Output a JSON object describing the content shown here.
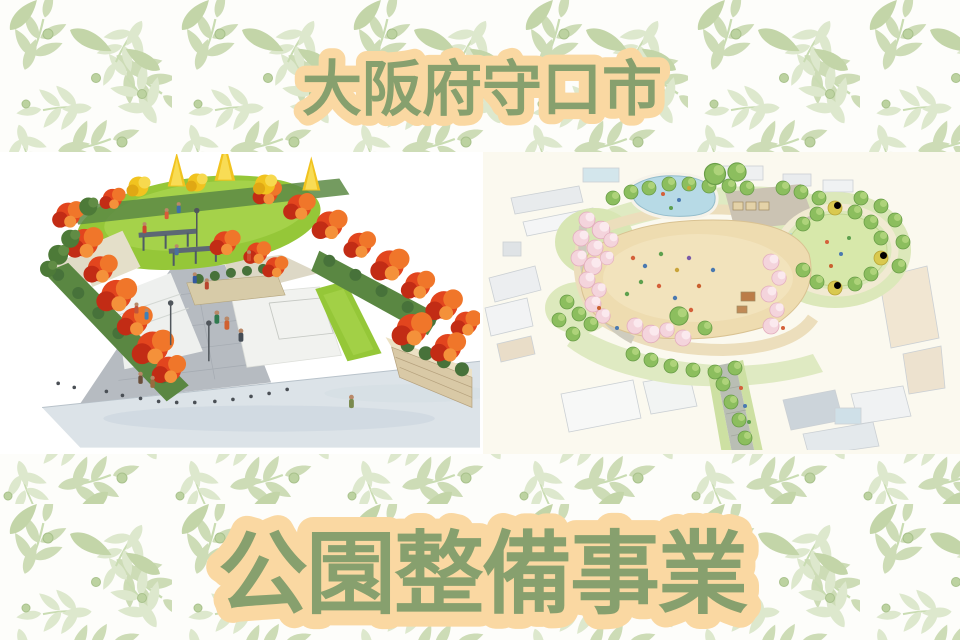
{
  "banner": {
    "top_title": "大阪府守口市",
    "bottom_title": "公園整備事業"
  },
  "illustrations": {
    "left_name": "autumn-park-perspective-illustration",
    "right_name": "park-aerial-plan-illustration"
  },
  "colors": {
    "title_green": "#87a06e",
    "title_outline_peach": "#fad8a2",
    "leaf_pattern_green": "#cddcb6",
    "leaf_pattern_green_light": "#dde8cd",
    "band_white": "#ffffff",
    "right_panel_cream": "#fbf9ef",
    "lawn_green": "#95c738",
    "autumn_red": "#e2451e",
    "autumn_orange": "#f0762a",
    "ginkgo_yellow": "#f1c31f",
    "hedge_green": "#5a8742",
    "path_gray": "#b6bbc1",
    "street_gray": "#dce3e8",
    "stone_wall_tan": "#d9c9a6",
    "sand_field_tan": "#eedcb0",
    "pond_blue": "#b7dae6",
    "cherry_pink": "#f4d4dc",
    "tree_green": "#8cbe5e",
    "round_lawn_green": "#d7e8aa"
  }
}
